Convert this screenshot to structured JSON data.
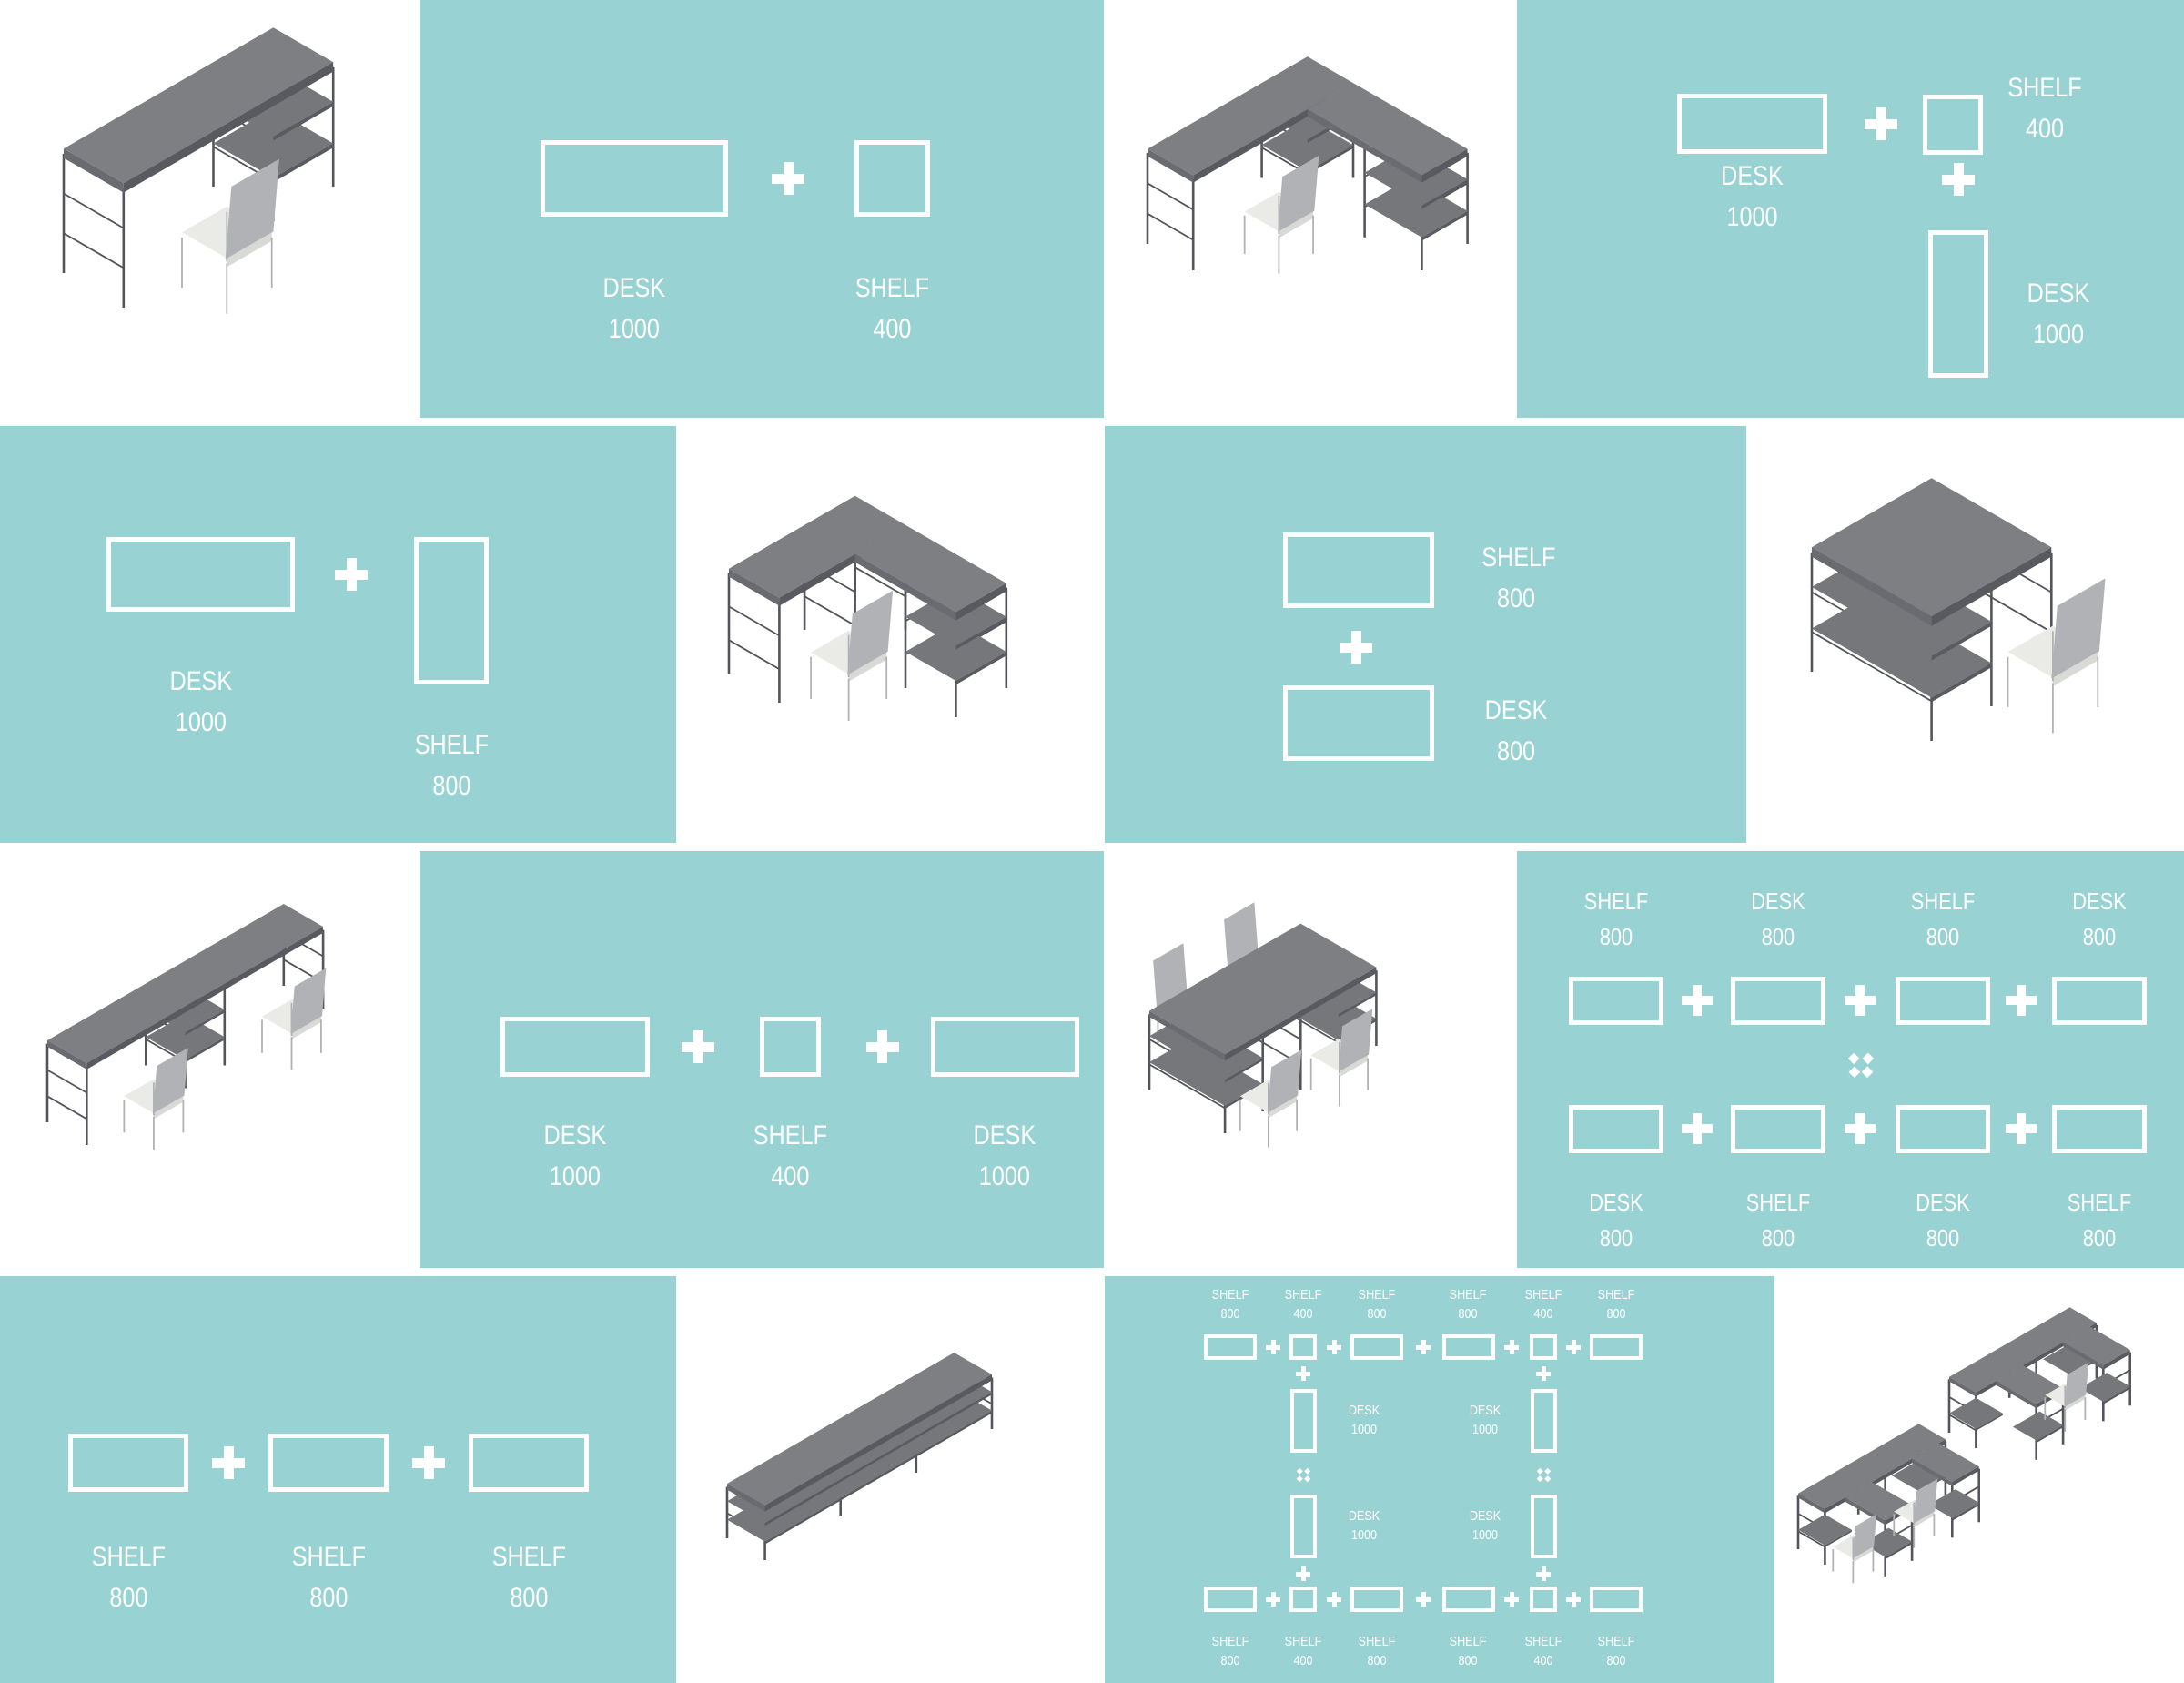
{
  "colors": {
    "teal": "#99d2d3",
    "label": "#ffffff",
    "furniture_top": "#7e7f83",
    "furniture_frame": "#54555a",
    "chair_seat": "#eaeae6"
  },
  "diagrams": {
    "r1c2": {
      "modules": [
        {
          "label": "DESK",
          "value": "1000"
        },
        {
          "label": "SHELF",
          "value": "400"
        }
      ]
    },
    "r1c4": {
      "desk": {
        "label": "DESK",
        "value": "1000"
      },
      "shelf": {
        "label": "SHELF",
        "value": "400"
      },
      "desk2": {
        "label": "DESK",
        "value": "1000"
      }
    },
    "r2c1": {
      "modules": [
        {
          "label": "DESK",
          "value": "1000"
        },
        {
          "label": "SHELF",
          "value": "800"
        }
      ]
    },
    "r2c3": {
      "modules": [
        {
          "label": "SHELF",
          "value": "800"
        },
        {
          "label": "DESK",
          "value": "800"
        }
      ]
    },
    "r3c2": {
      "modules": [
        {
          "label": "DESK",
          "value": "1000"
        },
        {
          "label": "SHELF",
          "value": "400"
        },
        {
          "label": "DESK",
          "value": "1000"
        }
      ]
    },
    "r3c4": {
      "top": [
        {
          "label": "SHELF",
          "value": "800"
        },
        {
          "label": "DESK",
          "value": "800"
        },
        {
          "label": "SHELF",
          "value": "800"
        },
        {
          "label": "DESK",
          "value": "800"
        }
      ],
      "bottom": [
        {
          "label": "DESK",
          "value": "800"
        },
        {
          "label": "SHELF",
          "value": "800"
        },
        {
          "label": "DESK",
          "value": "800"
        },
        {
          "label": "SHELF",
          "value": "800"
        }
      ]
    },
    "r4c1": {
      "modules": [
        {
          "label": "SHELF",
          "value": "800"
        },
        {
          "label": "SHELF",
          "value": "800"
        },
        {
          "label": "SHELF",
          "value": "800"
        }
      ]
    },
    "r4c3": {
      "top": [
        {
          "label": "SHELF",
          "value": "800"
        },
        {
          "label": "SHELF",
          "value": "400"
        },
        {
          "label": "SHELF",
          "value": "800"
        },
        {
          "label": "SHELF",
          "value": "800"
        },
        {
          "label": "SHELF",
          "value": "400"
        },
        {
          "label": "SHELF",
          "value": "800"
        }
      ],
      "middle": [
        {
          "label": "DESK",
          "value": "1000"
        },
        {
          "label": "DESK",
          "value": "1000"
        },
        {
          "label": "DESK",
          "value": "1000"
        },
        {
          "label": "DESK",
          "value": "1000"
        }
      ],
      "bottom": [
        {
          "label": "SHELF",
          "value": "800"
        },
        {
          "label": "SHELF",
          "value": "400"
        },
        {
          "label": "SHELF",
          "value": "800"
        },
        {
          "label": "SHELF",
          "value": "800"
        },
        {
          "label": "SHELF",
          "value": "400"
        },
        {
          "label": "SHELF",
          "value": "800"
        }
      ]
    }
  },
  "illustrations": {
    "r1c1": "desk-1000-with-shelf-400-and-chair",
    "r1c3": "l-shaped-desk-1000-shelf-400-desk-1000-with-chair",
    "r2c2": "l-shaped-desk-1000-shelf-800-with-chair",
    "r2c4": "shelf-800-desk-800-block-with-chair",
    "r3c1": "double-desk-1000-shelf-400-desk-1000-two-chairs",
    "r3c3": "double-sided-desk-shelf-800-run-four-chairs",
    "r4c2": "shelf-800-x3-sideboard",
    "r4c4": "office-cluster-of-desk-shelf-islands"
  }
}
